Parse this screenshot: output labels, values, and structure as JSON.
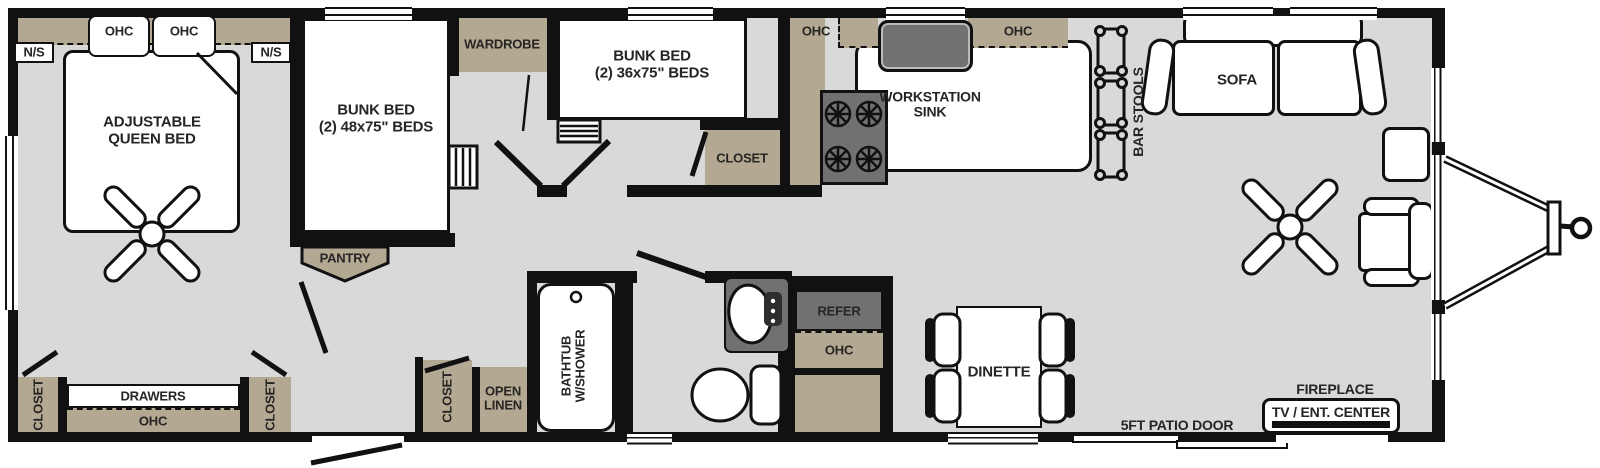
{
  "colors": {
    "wall": "#111111",
    "floor": "#d9d9d9",
    "cabinet_tan": "#b3a892",
    "appliance_gray": "#6f7173",
    "background": "#ffffff",
    "label_text": "#262524"
  },
  "bedroom": {
    "ohc_left": "OHC",
    "ohc_right": "OHC",
    "ns_left": "N/S",
    "ns_right": "N/S",
    "bed_line1": "ADJUSTABLE",
    "bed_line2": "QUEEN BED",
    "closet_left": "CLOSET",
    "drawers": "DRAWERS",
    "ohc_bottom": "OHC",
    "closet_right": "CLOSET"
  },
  "bunk_room_1": {
    "bed_line1": "BUNK BED",
    "bed_line2": "(2) 48x75\" BEDS",
    "pantry": "PANTRY",
    "wardrobe": "WARDROBE"
  },
  "bunk_room_2": {
    "bed_line1": "BUNK BED",
    "bed_line2": "(2) 36x75\" BEDS",
    "closet": "CLOSET"
  },
  "hall": {
    "closet": "CLOSET",
    "linen_line1": "OPEN",
    "linen_line2": "LINEN"
  },
  "bathroom": {
    "tub_line1": "BATHTUB",
    "tub_line2": "W/SHOWER"
  },
  "kitchen": {
    "ohc_left": "OHC",
    "ohc_right": "OHC",
    "sink_line1": "WORKSTATION",
    "sink_line2": "SINK",
    "bar_stools": "BAR STOOLS",
    "refer": "REFER",
    "refer_ohc": "OHC"
  },
  "living": {
    "sofa": "SOFA",
    "dinette": "DINETTE",
    "patio_door": "5FT PATIO DOOR",
    "fireplace": "FIREPLACE",
    "tv_center": "TV / ENT. CENTER"
  }
}
